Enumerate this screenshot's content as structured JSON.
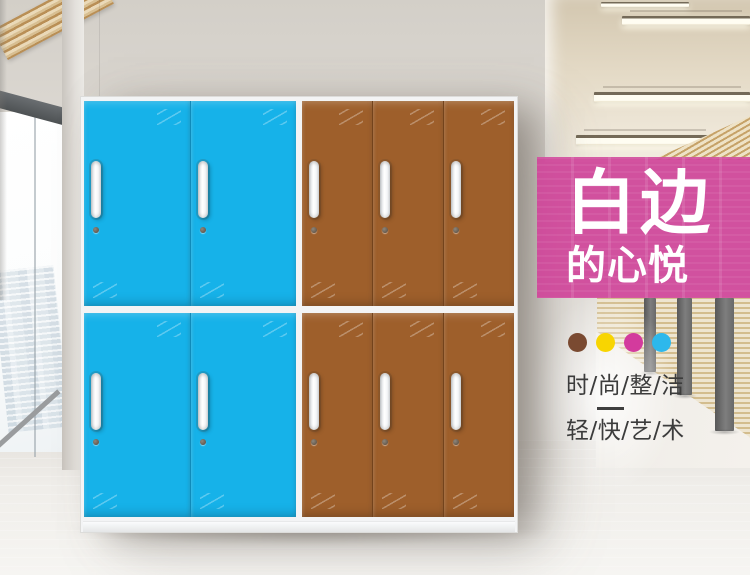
{
  "banner": {
    "title": "白边",
    "subtitle": "的心悦",
    "background_color": "#d0469a"
  },
  "palette_dots": [
    {
      "name": "brown",
      "color": "#7a4a31"
    },
    {
      "name": "yellow",
      "color": "#f8d501"
    },
    {
      "name": "magenta",
      "color": "#d33b9d"
    },
    {
      "name": "cyan",
      "color": "#2db8ec"
    }
  ],
  "slogan": {
    "line1": "时/尚/整/洁",
    "line2": "轻/快/艺/术"
  },
  "lockers": {
    "rows": 2,
    "sections": [
      {
        "name": "blue",
        "columns": 2,
        "door_color": "#16b2e9",
        "divider_color": "rgba(8,92,128,0.45)"
      },
      {
        "name": "brown",
        "columns": 3,
        "door_color": "#9e5f2b",
        "divider_color": "rgba(62,34,10,0.45)"
      }
    ]
  }
}
